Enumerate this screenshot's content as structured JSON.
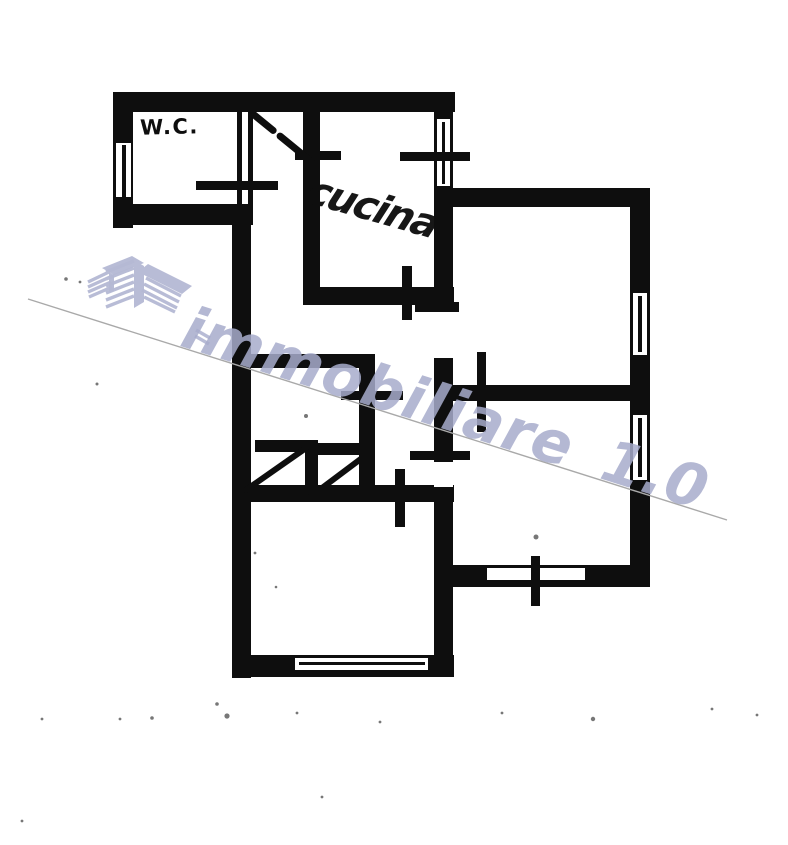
{
  "page": {
    "bg": "#ffffff",
    "ink": "#0e0e0e"
  },
  "labels": {
    "wc": "W.C.",
    "kitchen": "cucina"
  },
  "watermark": {
    "text": "immobiliare 1.0",
    "color": "rgba(167,172,203,0.85)",
    "logo_color": "#b5b9d4",
    "logo_name": "buildings-logo"
  },
  "scan": {
    "line": {
      "x1": 28,
      "y1": 299,
      "x2": 727,
      "y2": 520,
      "color": "#a9a9a9",
      "w": 1.4
    }
  },
  "floorplan": {
    "ink": "#0e0e0e",
    "walls": [
      {
        "name": "top-exterior-wall",
        "x": 113,
        "y": 92,
        "w": 342,
        "h": 20
      },
      {
        "name": "wc-left-exterior-wall",
        "x": 113,
        "y": 92,
        "w": 20,
        "h": 136
      },
      {
        "name": "wc-bottom-wall",
        "x": 113,
        "y": 204,
        "w": 140,
        "h": 21
      },
      {
        "name": "wc-door-wall-outer-line",
        "x": 237,
        "y": 112,
        "w": 5,
        "h": 97
      },
      {
        "name": "wc-door-wall-inner-line",
        "x": 248,
        "y": 112,
        "w": 5,
        "h": 97
      },
      {
        "name": "left-exterior-wall",
        "x": 232,
        "y": 204,
        "w": 19,
        "h": 474
      },
      {
        "name": "kitchen-left-wall",
        "x": 303,
        "y": 112,
        "w": 17,
        "h": 192
      },
      {
        "name": "kitchen-bottom-wall",
        "x": 303,
        "y": 287,
        "w": 151,
        "h": 18
      },
      {
        "name": "central-vertical-wall",
        "x": 434,
        "y": 92,
        "w": 19,
        "h": 585
      },
      {
        "name": "upper-right-room-top-wall",
        "x": 434,
        "y": 188,
        "w": 216,
        "h": 19
      },
      {
        "name": "right-exterior-wall",
        "x": 630,
        "y": 188,
        "w": 20,
        "h": 399
      },
      {
        "name": "right-rooms-divider-wall",
        "x": 453,
        "y": 385,
        "w": 179,
        "h": 16
      },
      {
        "name": "lower-right-room-bottom-wall",
        "x": 448,
        "y": 565,
        "w": 202,
        "h": 22
      },
      {
        "name": "hall-bottom-wall",
        "x": 232,
        "y": 485,
        "w": 222,
        "h": 17
      },
      {
        "name": "middle-room-top-wall",
        "x": 248,
        "y": 354,
        "w": 126,
        "h": 14
      },
      {
        "name": "middle-room-right-wall",
        "x": 359,
        "y": 354,
        "w": 16,
        "h": 138
      },
      {
        "name": "door-lintel-left",
        "x": 255,
        "y": 440,
        "w": 52,
        "h": 12
      },
      {
        "name": "door-stub-wall",
        "x": 305,
        "y": 440,
        "w": 13,
        "h": 60
      },
      {
        "name": "door-lintel-right",
        "x": 318,
        "y": 443,
        "w": 53,
        "h": 12
      },
      {
        "name": "bottom-left-room-bottom-wall",
        "x": 232,
        "y": 655,
        "w": 222,
        "h": 22
      }
    ],
    "openings": [
      {
        "name": "wc-window-slot",
        "x": 116,
        "y": 143,
        "w": 15,
        "h": 54
      },
      {
        "name": "kitchen-window-slot",
        "x": 437,
        "y": 119,
        "w": 13,
        "h": 67
      },
      {
        "name": "upper-right-window-slot",
        "x": 633,
        "y": 293,
        "w": 14,
        "h": 62
      },
      {
        "name": "lower-right-window-slot",
        "x": 633,
        "y": 415,
        "w": 14,
        "h": 65
      },
      {
        "name": "bottom-left-window-slot",
        "x": 295,
        "y": 658,
        "w": 133,
        "h": 12
      },
      {
        "name": "bottom-right-window-slot",
        "x": 487,
        "y": 568,
        "w": 98,
        "h": 12
      },
      {
        "name": "upper-door-gap",
        "x": 434,
        "y": 310,
        "w": 19,
        "h": 48
      },
      {
        "name": "lower-door-gap",
        "x": 434,
        "y": 462,
        "w": 19,
        "h": 25
      }
    ],
    "marks": [
      {
        "name": "wc-window-midline",
        "x": 122,
        "y": 145,
        "w": 4,
        "h": 52
      },
      {
        "name": "kitchen-window-midline",
        "x": 442,
        "y": 122,
        "w": 3,
        "h": 62
      },
      {
        "name": "upper-right-window-midline",
        "x": 638,
        "y": 296,
        "w": 4,
        "h": 56
      },
      {
        "name": "lower-right-window-midline",
        "x": 638,
        "y": 418,
        "w": 4,
        "h": 59
      },
      {
        "name": "bottom-left-window-midline",
        "x": 299,
        "y": 662,
        "w": 126,
        "h": 3
      },
      {
        "name": "wc-door-marker",
        "x": 196,
        "y": 181,
        "w": 82,
        "h": 9
      },
      {
        "name": "kitchen-window-marker",
        "x": 400,
        "y": 152,
        "w": 70,
        "h": 9
      },
      {
        "name": "kitchen-entry-door-marker",
        "x": 295,
        "y": 151,
        "w": 46,
        "h": 9
      },
      {
        "name": "kitchen-bottom-door-marker",
        "x": 402,
        "y": 266,
        "w": 10,
        "h": 54
      },
      {
        "name": "hall-upper-right-door-marker",
        "x": 415,
        "y": 302,
        "w": 44,
        "h": 10
      },
      {
        "name": "middle-room-door-marker",
        "x": 341,
        "y": 391,
        "w": 62,
        "h": 9
      },
      {
        "name": "hall-lower-right-door-marker",
        "x": 410,
        "y": 451,
        "w": 60,
        "h": 9
      },
      {
        "name": "bottom-left-room-door-marker",
        "x": 395,
        "y": 469,
        "w": 10,
        "h": 58
      },
      {
        "name": "divider-door-marker",
        "x": 477,
        "y": 352,
        "w": 9,
        "h": 80
      },
      {
        "name": "bottom-right-window-marker",
        "x": 531,
        "y": 556,
        "w": 9,
        "h": 50
      }
    ],
    "swings": [
      {
        "name": "entry-door-swing",
        "x1": 253,
        "y1": 114,
        "x2": 313,
        "y2": 163,
        "w": 7,
        "dash": "26 9 40"
      },
      {
        "name": "left-door-swing",
        "x1": 246,
        "y1": 490,
        "x2": 306,
        "y2": 448,
        "w": 6,
        "dash": ""
      },
      {
        "name": "right-door-swing",
        "x1": 310,
        "y1": 497,
        "x2": 370,
        "y2": 452,
        "w": 6,
        "dash": ""
      }
    ],
    "specks": [
      [
        306,
        416,
        2
      ],
      [
        536,
        537,
        2.5
      ],
      [
        97,
        384,
        1.5
      ],
      [
        66,
        279,
        1.8
      ],
      [
        80,
        282,
        1.4
      ],
      [
        152,
        718,
        1.8
      ],
      [
        227,
        716,
        2.6
      ],
      [
        297,
        713,
        1.4
      ],
      [
        380,
        722,
        1.4
      ],
      [
        502,
        713,
        1.4
      ],
      [
        593,
        719,
        2.2
      ],
      [
        712,
        709,
        1.4
      ],
      [
        757,
        715,
        1.4
      ],
      [
        120,
        719,
        1.4
      ],
      [
        42,
        719,
        1.4
      ],
      [
        217,
        704,
        1.8
      ],
      [
        322,
        797,
        1.4
      ],
      [
        22,
        821,
        1.4
      ],
      [
        255,
        553,
        1.4
      ],
      [
        276,
        587,
        1.3
      ]
    ]
  }
}
